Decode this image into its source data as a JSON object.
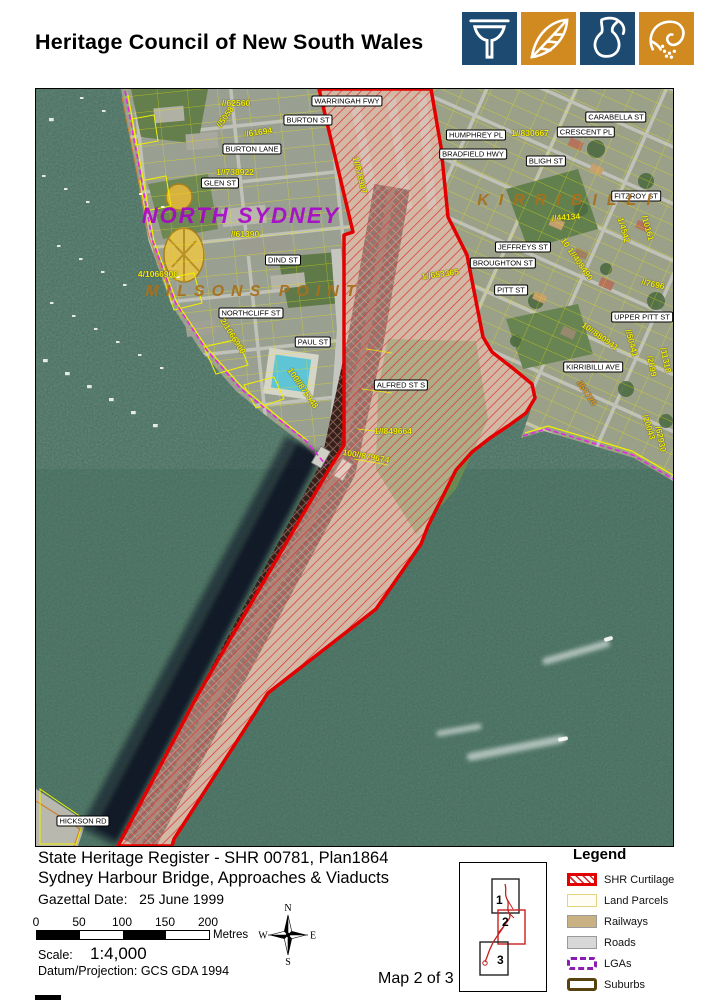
{
  "header": {
    "title": "Heritage Council of New South Wales",
    "logo_tiles": [
      {
        "icon": "column-icon",
        "bg": "#1c4a70"
      },
      {
        "icon": "leaf-icon",
        "bg": "#d18a1f"
      },
      {
        "icon": "jug-icon",
        "bg": "#1c4a70"
      },
      {
        "icon": "hand-seeds-icon",
        "bg": "#d18a1f"
      }
    ]
  },
  "map": {
    "suburb_labels": [
      {
        "text": "NORTH SYDNEY",
        "x": 205,
        "y": 127,
        "style": "ns",
        "ls": 2
      },
      {
        "text": "MILSONS POINT",
        "x": 218,
        "y": 203,
        "style": "or",
        "ls": 7
      },
      {
        "text": "KIRRIBILLI",
        "x": 533,
        "y": 112,
        "style": "or",
        "ls": 10
      }
    ],
    "street_labels": [
      {
        "text": "WARRINGAH FWY",
        "x": 311,
        "y": 12
      },
      {
        "text": "BURTON ST",
        "x": 272,
        "y": 31
      },
      {
        "text": "BURTON LANE",
        "x": 216,
        "y": 60
      },
      {
        "text": "GLEN ST",
        "x": 184,
        "y": 94
      },
      {
        "text": "DIND ST",
        "x": 247,
        "y": 171
      },
      {
        "text": "NORTHCLIFF ST",
        "x": 215,
        "y": 224
      },
      {
        "text": "PAUL ST",
        "x": 277,
        "y": 253
      },
      {
        "text": "ALFRED ST S",
        "x": 365,
        "y": 296
      },
      {
        "text": "HUMPHREY PL",
        "x": 440,
        "y": 46
      },
      {
        "text": "BRADFIELD HWY",
        "x": 437,
        "y": 65
      },
      {
        "text": "CRESCENT PL",
        "x": 550,
        "y": 43
      },
      {
        "text": "CARABELLA ST",
        "x": 580,
        "y": 28
      },
      {
        "text": "BLIGH ST",
        "x": 510,
        "y": 72
      },
      {
        "text": "FITZROY ST",
        "x": 600,
        "y": 107
      },
      {
        "text": "JEFFREYS ST",
        "x": 487,
        "y": 158
      },
      {
        "text": "BROUGHTON ST",
        "x": 467,
        "y": 174
      },
      {
        "text": "PITT ST",
        "x": 475,
        "y": 201
      },
      {
        "text": "UPPER PITT ST",
        "x": 606,
        "y": 228
      },
      {
        "text": "KIRRIBILLI AVE",
        "x": 557,
        "y": 278
      },
      {
        "text": "HICKSON RD",
        "x": 47,
        "y": 732
      }
    ],
    "lot_labels": [
      {
        "text": "//62560",
        "x": 200,
        "y": 14,
        "rot": 0
      },
      {
        "text": "//5058",
        "x": 189,
        "y": 28,
        "rot": -55
      },
      {
        "text": "//61694",
        "x": 222,
        "y": 43,
        "rot": -8
      },
      {
        "text": "1//738922",
        "x": 199,
        "y": 83,
        "rot": 0
      },
      {
        "text": "//61390",
        "x": 209,
        "y": 145,
        "rot": 0
      },
      {
        "text": "4/1066900",
        "x": 122,
        "y": 185,
        "rot": 0
      },
      {
        "text": "2/1066900",
        "x": 197,
        "y": 247,
        "rot": 58
      },
      {
        "text": "100//875948",
        "x": 267,
        "y": 299,
        "rot": 55
      },
      {
        "text": "1//873987",
        "x": 324,
        "y": 86,
        "rot": 76
      },
      {
        "text": "1//830667",
        "x": 494,
        "y": 44,
        "rot": 0
      },
      {
        "text": "//44134",
        "x": 530,
        "y": 128,
        "rot": -4
      },
      {
        "text": "1//653365",
        "x": 404,
        "y": 185,
        "rot": -8
      },
      {
        "text": "10 1//408490",
        "x": 541,
        "y": 170,
        "rot": 55
      },
      {
        "text": "//7696",
        "x": 617,
        "y": 195,
        "rot": 12
      },
      {
        "text": "1/4542",
        "x": 588,
        "y": 141,
        "rot": 74
      },
      {
        "text": "/10161",
        "x": 612,
        "y": 139,
        "rot": 74
      },
      {
        "text": "10//880941",
        "x": 564,
        "y": 247,
        "rot": 35
      },
      {
        "text": "//50441",
        "x": 596,
        "y": 254,
        "rot": 74
      },
      {
        "text": "/2699",
        "x": 616,
        "y": 277,
        "rot": 78
      },
      {
        "text": "/11318",
        "x": 630,
        "y": 271,
        "rot": 78
      },
      {
        "text": "//50720",
        "x": 551,
        "y": 304,
        "rot": 55,
        "orange": true
      },
      {
        "text": "/20043",
        "x": 613,
        "y": 338,
        "rot": 72
      },
      {
        "text": "/62930",
        "x": 625,
        "y": 350,
        "rot": 78
      },
      {
        "text": "1//849664",
        "x": 357,
        "y": 342,
        "rot": 0
      },
      {
        "text": "100//879674",
        "x": 330,
        "y": 367,
        "rot": 10
      }
    ]
  },
  "footer": {
    "title_line1": "State Heritage Register - SHR 00781, Plan1864",
    "title_line2": "Sydney Harbour Bridge, Approaches & Viaducts",
    "gazettal_label": "Gazettal Date:",
    "gazettal_value": "25 June 1999",
    "scalebar": {
      "ticks": [
        "0",
        "50",
        "100",
        "150",
        "200"
      ],
      "unit": "Metres"
    },
    "scale_label": "Scale:",
    "scale_value": "1:4,000",
    "datum": "Datum/Projection: GCS GDA 1994",
    "map_number": "Map 2 of 3",
    "compass": {
      "n": "N",
      "e": "E",
      "s": "S",
      "w": "W"
    },
    "inset": {
      "boxes": [
        "1",
        "2",
        "3"
      ]
    },
    "legend": {
      "title": "Legend",
      "items": [
        {
          "label": "SHR Curtilage",
          "type": "shr"
        },
        {
          "label": "Land Parcels",
          "type": "parcels"
        },
        {
          "label": "Railways",
          "type": "railways"
        },
        {
          "label": "Roads",
          "type": "roads"
        },
        {
          "label": "LGAs",
          "type": "lgas"
        },
        {
          "label": "Suburbs",
          "type": "suburbs"
        }
      ]
    }
  },
  "colors": {
    "logo_navy": "#1c4a70",
    "logo_orange": "#d18a1f",
    "shr_red": "#e20000",
    "parcel_yellow": "#f0f000",
    "lga_purple": "#8a1cb2",
    "suburb_brown": "#584310",
    "water": "#46705f"
  }
}
